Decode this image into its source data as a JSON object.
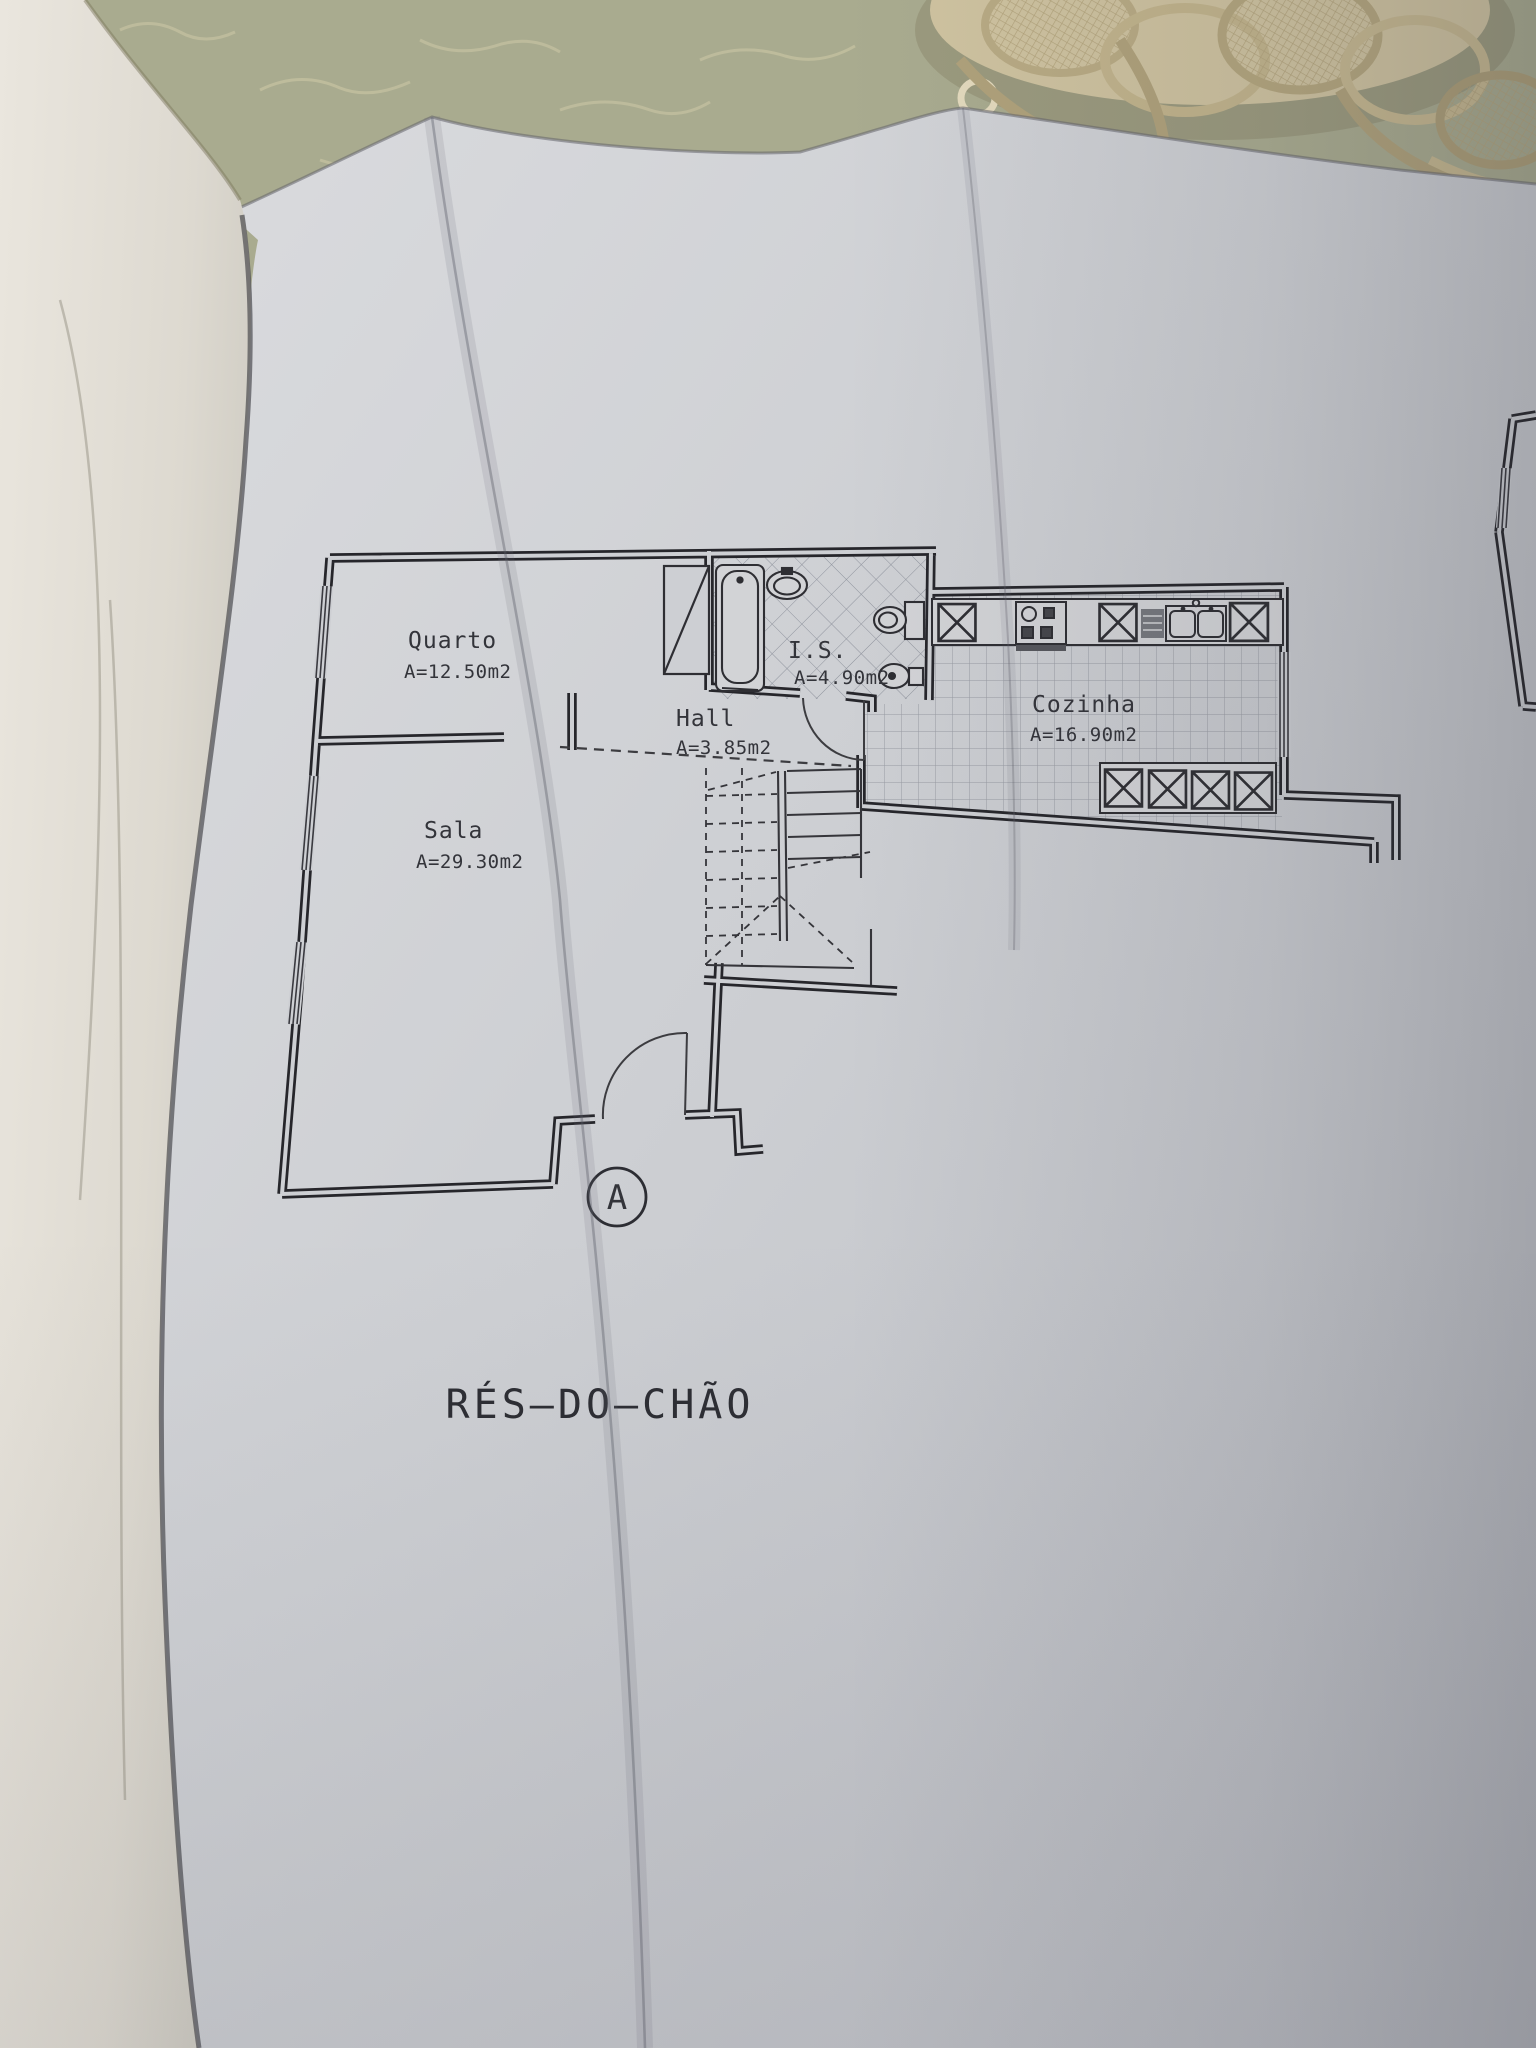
{
  "plan": {
    "title": "RÉS–DO–CHÃO",
    "section_marker": "A",
    "rooms": [
      {
        "name": "Quarto",
        "area": "A=12.50m2"
      },
      {
        "name": "Sala",
        "area": "A=29.30m2"
      },
      {
        "name": "Hall",
        "area": "A=3.85m2"
      },
      {
        "name": "I.S.",
        "area": "A=4.90m2"
      },
      {
        "name": "Cozinha",
        "area": "A=16.90m2"
      }
    ]
  },
  "colors": {
    "ink": "#2e2e33",
    "paper_grey": "#cdcfd3",
    "flipped_pages": "#e4e0d8",
    "tablecloth": "#a9ab8f",
    "doily": "#d3c7a5"
  }
}
